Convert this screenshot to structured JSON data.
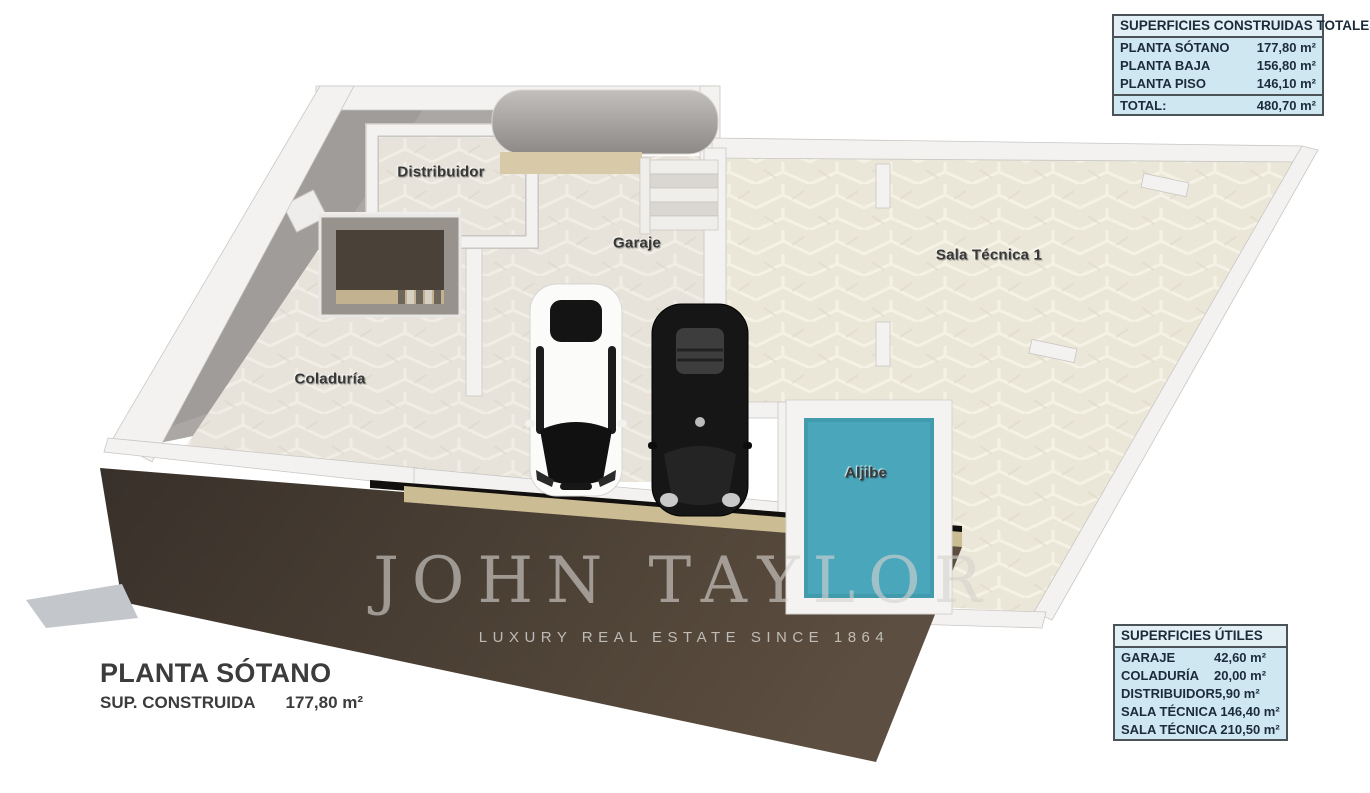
{
  "watermark": {
    "brand": "JOHN TAYLOR",
    "tagline": "LUXURY REAL ESTATE SINCE 1864"
  },
  "title_block": {
    "title": "PLANTA SÓTANO",
    "built_label": "SUP. CONSTRUIDA",
    "built_value": "177,80 m²"
  },
  "floor_plan": {
    "level_name": "PLANTA SÓTANO",
    "rooms": [
      {
        "id": "distribuidor",
        "label": "Distribuidor"
      },
      {
        "id": "garaje",
        "label": "Garaje"
      },
      {
        "id": "sala-tecnica-1",
        "label": "Sala Técnica 1"
      },
      {
        "id": "coladuria",
        "label": "Coladuría"
      },
      {
        "id": "aljibe",
        "label": "Aljibe"
      }
    ],
    "features": [
      "white-car",
      "black-car",
      "staircase",
      "access-ramp",
      "water-tank"
    ],
    "colors": {
      "floor_tile": "#e7e3da",
      "floor_tile_warm": "#ebe7d8",
      "wall_white": "#f3f2f0",
      "wall_gray": "#a9a6a3",
      "ramp_brown": "#4a3f34",
      "aljibe_teal": "#4aa6ba",
      "table_bg": "#cfe7f1",
      "table_border": "#4b5258",
      "table_text": "#1c2b3b"
    }
  },
  "tables": {
    "built_areas": {
      "title": "SUPERFICIES CONSTRUIDAS TOTALES",
      "rows": [
        {
          "label": "PLANTA SÓTANO",
          "value": "177,80 m²"
        },
        {
          "label": "PLANTA BAJA",
          "value": "156,80 m²"
        },
        {
          "label": "PLANTA PISO",
          "value": "146,10 m²"
        }
      ],
      "total": {
        "label": "TOTAL:",
        "value": "480,70 m²"
      }
    },
    "usable_areas": {
      "title": "SUPERFICIES ÚTILES",
      "rows": [
        {
          "label": "GARAJE",
          "value": "42,60 m²"
        },
        {
          "label": "COLADURÍA",
          "value": "20,00 m²"
        },
        {
          "label": "DISTRIBUIDOR",
          "value": "5,90 m²"
        },
        {
          "label": "SALA TÉCNICA 1",
          "value": "46,40 m²"
        },
        {
          "label": "SALA TÉCNICA 2",
          "value": "10,50 m²"
        }
      ]
    }
  }
}
